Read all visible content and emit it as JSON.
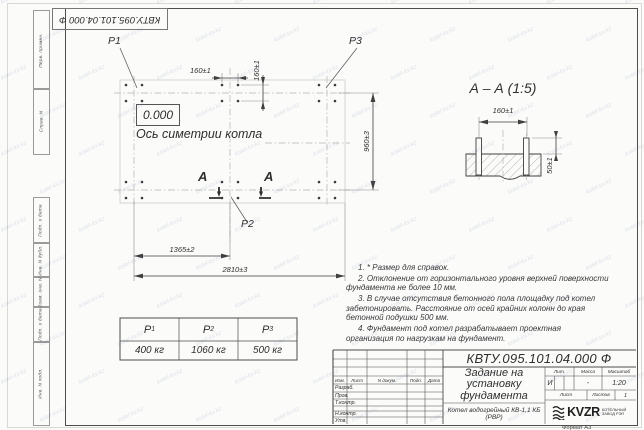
{
  "watermark": {
    "text": "kotel-kv.kz"
  },
  "stamp": {
    "designation_top": "КВТУ.095.101.04.000 Ф"
  },
  "side_column": {
    "top": [
      "Перв. примен.",
      "Справ. N"
    ],
    "bottom": [
      "Подп. и дата",
      "Инв. N дубл.",
      "Взам. инв. N",
      "Подп. и дата",
      "Инв. N подл."
    ]
  },
  "plan": {
    "load_labels": {
      "p1": "P1",
      "p2": "P2",
      "p3": "P3"
    },
    "elevation": "0.000",
    "axis_label": "Ось симетрии котла",
    "section_mark": "А",
    "dims": {
      "bolt_spacing_h": "160±1",
      "bolt_spacing_v": "160±1",
      "row_spacing": "960±3",
      "col_spacing": "1365±2",
      "total_width": "2810±3"
    }
  },
  "section_view": {
    "title": "А – А (1:5)",
    "dims": {
      "bolt_spacing": "160±1",
      "protrusion": "50±1"
    }
  },
  "loads_table": {
    "columns": [
      {
        "name": "P",
        "sub": "1",
        "value": "400 кг"
      },
      {
        "name": "P",
        "sub": "2",
        "value": "1060 кг"
      },
      {
        "name": "P",
        "sub": "3",
        "value": "500 кг"
      }
    ]
  },
  "notes": {
    "items": [
      "1. * Размер для справок.",
      "2. Отклонение от горизонтального уровня верхней поверхности фундамента не более 10 мм.",
      "3. В случае отсутствия бетонного пола площадку под котел забетонировать. Расстояние от осей крайних колонн до края бетонной подушки 500 мм.",
      "4. Фундамент под котел разрабатывает проектная организация по нагрузкам на фундамент."
    ]
  },
  "title_block": {
    "designation": "КВТУ.095.101.04.000 Ф",
    "document_title": "Задание на установку фундамента",
    "subject": "Котел водогрейный КВ-1,1 КБ (РВР)",
    "columns": {
      "izm": "Изм.",
      "list": "Лист",
      "ndoc": "N докум.",
      "podp": "Подп.",
      "data": "Дата"
    },
    "role_rows": [
      "Разраб.",
      "Пров.",
      "Т.контр.",
      "Н.контр.",
      "Утв."
    ],
    "lit": {
      "label": "Лит.",
      "value": "И"
    },
    "mass": {
      "label": "Масса",
      "value": "-"
    },
    "scale": {
      "label": "Масштаб",
      "value": "1:20"
    },
    "sheet": {
      "label": "Лист"
    },
    "sheets": {
      "label": "Листов",
      "value": "1"
    },
    "company": {
      "name": "KVZR",
      "caption": "КОТЕЛЬНЫЙ ЗАВОД РЭП"
    },
    "format": "Формат А3"
  }
}
